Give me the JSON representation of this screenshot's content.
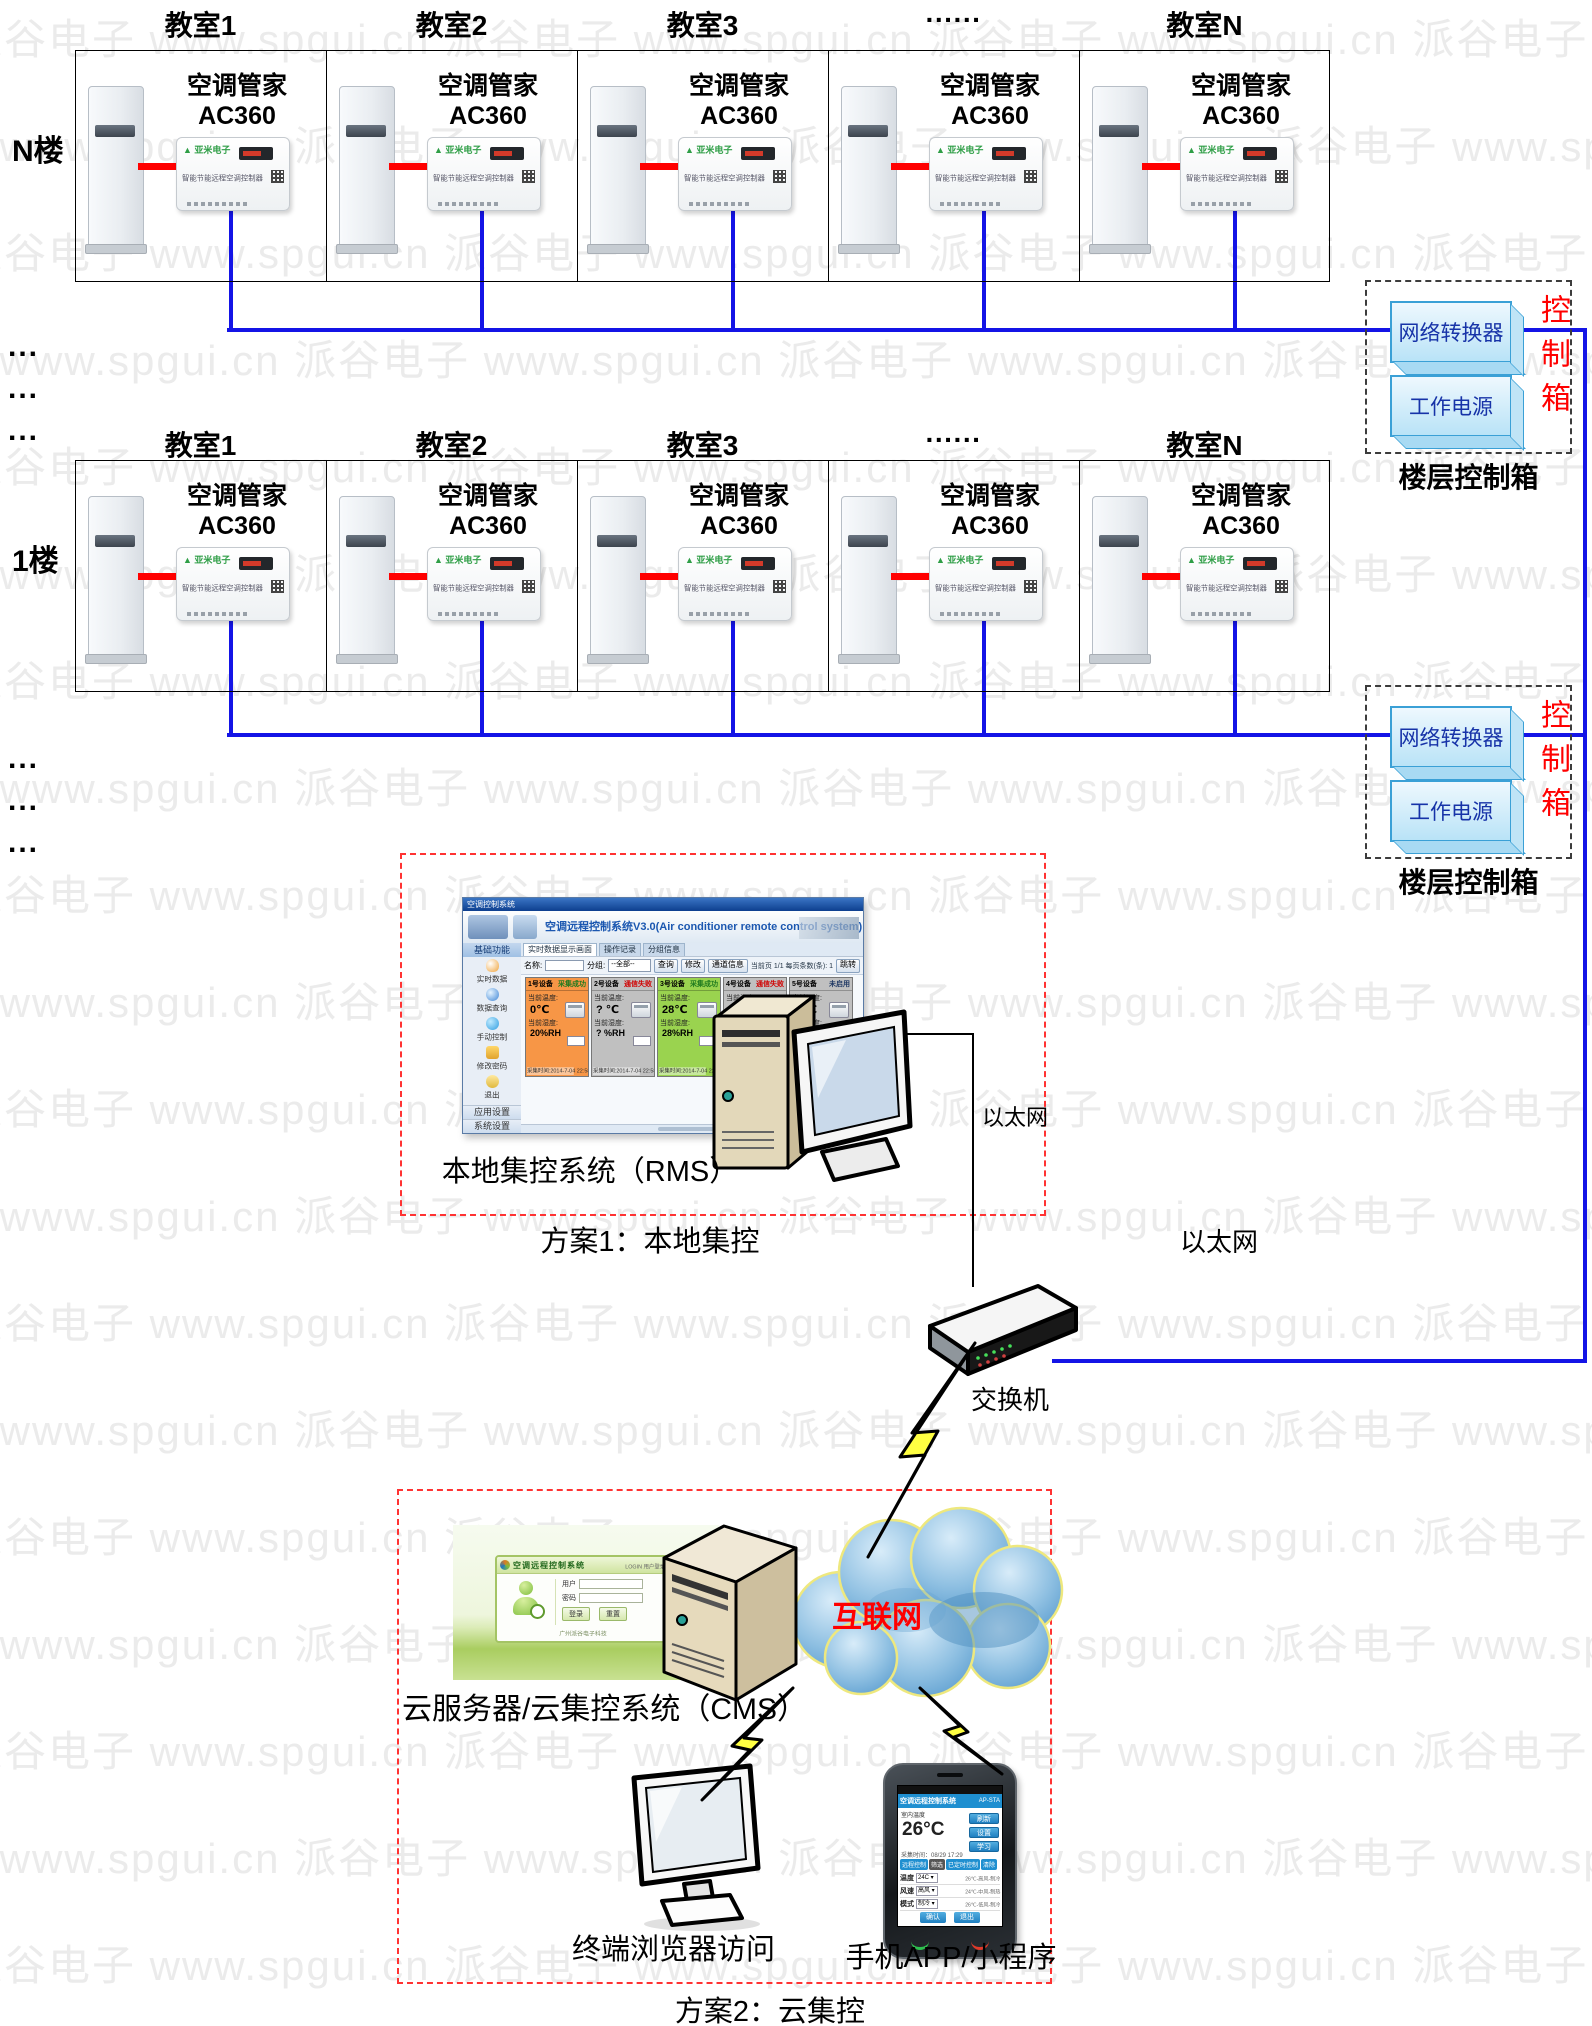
{
  "watermark": {
    "text": "派谷电子",
    "url": "www.spgui.cn",
    "color": "#ebebeb"
  },
  "floors": [
    {
      "floor_label": "N楼",
      "rooms": [
        "教室1",
        "教室2",
        "教室3",
        "······",
        "教室N"
      ]
    },
    {
      "floor_label": "1楼",
      "rooms": [
        "教室1",
        "教室2",
        "教室3",
        "······",
        "教室N"
      ]
    }
  ],
  "ellipsis": "...",
  "device": {
    "title_line1": "空调管家",
    "title_line2": "AC360",
    "brand": "亚米电子",
    "label": "智能节能远程空调控制器"
  },
  "control_box": {
    "converter": "网络转换器",
    "power": "工作电源",
    "side_label": "控制箱",
    "caption": "楼层控制箱"
  },
  "scheme1": {
    "box_label": "方案1：本地集控",
    "caption": "本地集控系统（RMS）",
    "ethernet_small": "以太网",
    "rms": {
      "titlebar": "空调控制系统",
      "title": "空调远程控制系统V3.0(Air conditioner remote control system)",
      "nav_header": "基础功能",
      "nav_items": [
        "实时数据",
        "数据查询",
        "手动控制",
        "修改密码",
        "退出"
      ],
      "nav_bottom": [
        "应用设置",
        "系统设置"
      ],
      "tabs": [
        "实时数据显示画面",
        "操作记录",
        "分组信息"
      ],
      "toolbar": {
        "name_label": "名称:",
        "group_label": "分组:",
        "group_value": "--全部--",
        "btn1": "查询",
        "btn2": "修改",
        "btn3": "通道信息",
        "page_info": "当前页 1/1  每页条数(条): 1",
        "jump": "跳转"
      },
      "temp_label": "当前温度:",
      "hum_label": "当前湿度:",
      "cards": [
        {
          "name": "1号设备",
          "status": "采集成功",
          "status_color": "#1f7a1f",
          "bg": "#f79646",
          "temp": "0℃",
          "hum": "20%RH",
          "time": "采集时间:2014-7-04 22:58:42"
        },
        {
          "name": "2号设备",
          "status": "通信失败",
          "status_color": "#d00000",
          "bg": "#c0c0c0",
          "temp": "? ℃",
          "hum": "? %RH",
          "time": "采集时间:2014-7-04 22:58:27"
        },
        {
          "name": "3号设备",
          "status": "采集成功",
          "status_color": "#1f7a1f",
          "bg": "#9ad34f",
          "temp": "28℃",
          "hum": "28%RH",
          "time": "采集时间:2014-7-04 22:58:13"
        },
        {
          "name": "4号设备",
          "status": "通信失败",
          "status_color": "#d00000",
          "bg": "#c0c0c0",
          "temp": "? ℃",
          "hum": "? %RH",
          "time": "采集时间:2014-7-04 22:58:36"
        },
        {
          "name": "5号设备",
          "status": "未启用",
          "status_color": "#1f3864",
          "bg": "#c0c0c0",
          "temp": "? ℃",
          "hum": "? %RH",
          "time": ""
        }
      ]
    }
  },
  "network": {
    "switch_label": "交换机",
    "ethernet_label": "以太网"
  },
  "scheme2": {
    "box_label": "方案2：云集控",
    "caption": "云服务器/云集控系统（CMS）",
    "internet_label": "互联网",
    "browser_caption": "终端浏览器访问",
    "app_caption": "手机APP/小程序",
    "cms": {
      "title": "空调远程控制系统",
      "login": "LOGIN 用户登录",
      "user": "用户",
      "pwd": "密码",
      "login_btn": "登录",
      "reset_btn": "重置",
      "footer": "广州派谷电子科技"
    },
    "app": {
      "title": "空调远程控制系统",
      "mode": "AP-STA",
      "temp_label": "室内温度",
      "temp": "26°C",
      "btns": [
        "刷新",
        "设置",
        "学习"
      ],
      "time": "采集时间：08/29 17:29",
      "tabs": [
        "远程控制",
        "筛选",
        "已定时控制",
        "清除"
      ],
      "rows": [
        [
          "温度",
          "24C",
          "26℃-高风-制冷"
        ],
        [
          "风速",
          "高风",
          "24℃-中风-制热"
        ],
        [
          "模式",
          "制冷",
          "26℃-低风-制冷"
        ]
      ],
      "actions": [
        "确认",
        "退出"
      ]
    }
  }
}
